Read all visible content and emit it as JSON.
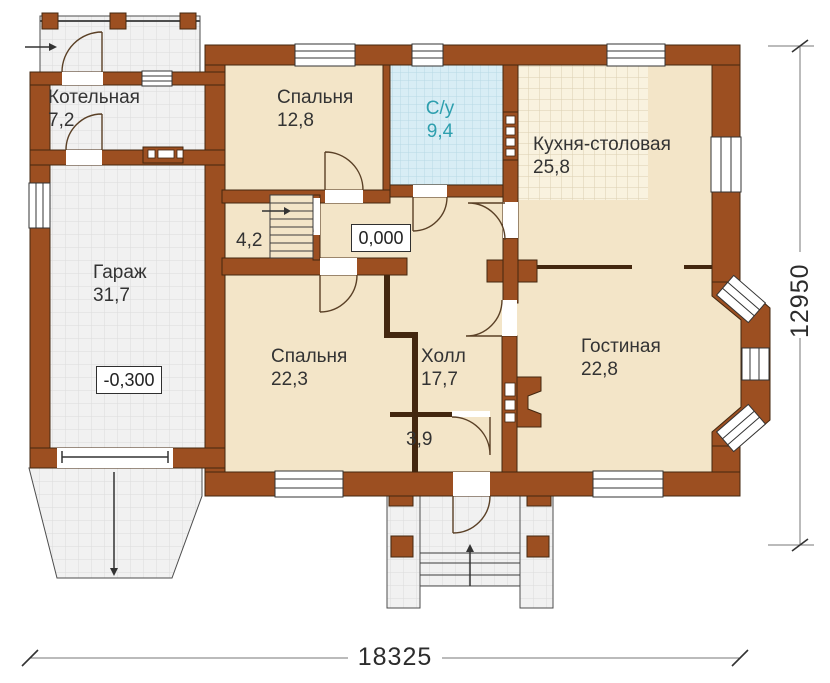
{
  "plan": {
    "rooms": {
      "kotelnaya": {
        "name": "Котельная",
        "area": "7,2"
      },
      "spalnya_1": {
        "name": "Спальня",
        "area": "12,8"
      },
      "sanuzel": {
        "name": "С/у",
        "area": "9,4"
      },
      "kuhnya": {
        "name": "Кухня-столовая",
        "area": "25,8"
      },
      "garazh": {
        "name": "Гараж",
        "area": "31,7"
      },
      "koridor": {
        "area": "4,2"
      },
      "spalnya_2": {
        "name": "Спальня",
        "area": "22,3"
      },
      "holl": {
        "name": "Холл",
        "area": "17,7"
      },
      "gostinaya": {
        "name": "Гостиная",
        "area": "22,8"
      },
      "tambur": {
        "area": "3,9"
      }
    },
    "elevations": {
      "main_floor": "0,000",
      "garage_floor": "-0,300"
    },
    "dimensions": {
      "overall_width": "18325",
      "overall_depth": "12950"
    }
  },
  "colors": {
    "wall": "#9c4f21",
    "outline": "#43270f",
    "floor_beige": "#f3e5c8",
    "floor_tile": "#f1f1f1",
    "floor_tile_line": "#dcdcdc",
    "kitchen_tile": "#f9f2df",
    "kitchen_tile_line": "#dbcfb2",
    "bathroom_tile": "#d8edf5",
    "bathroom_tile_line": "#b7d9e5",
    "accent_text": "#2e9fae"
  }
}
